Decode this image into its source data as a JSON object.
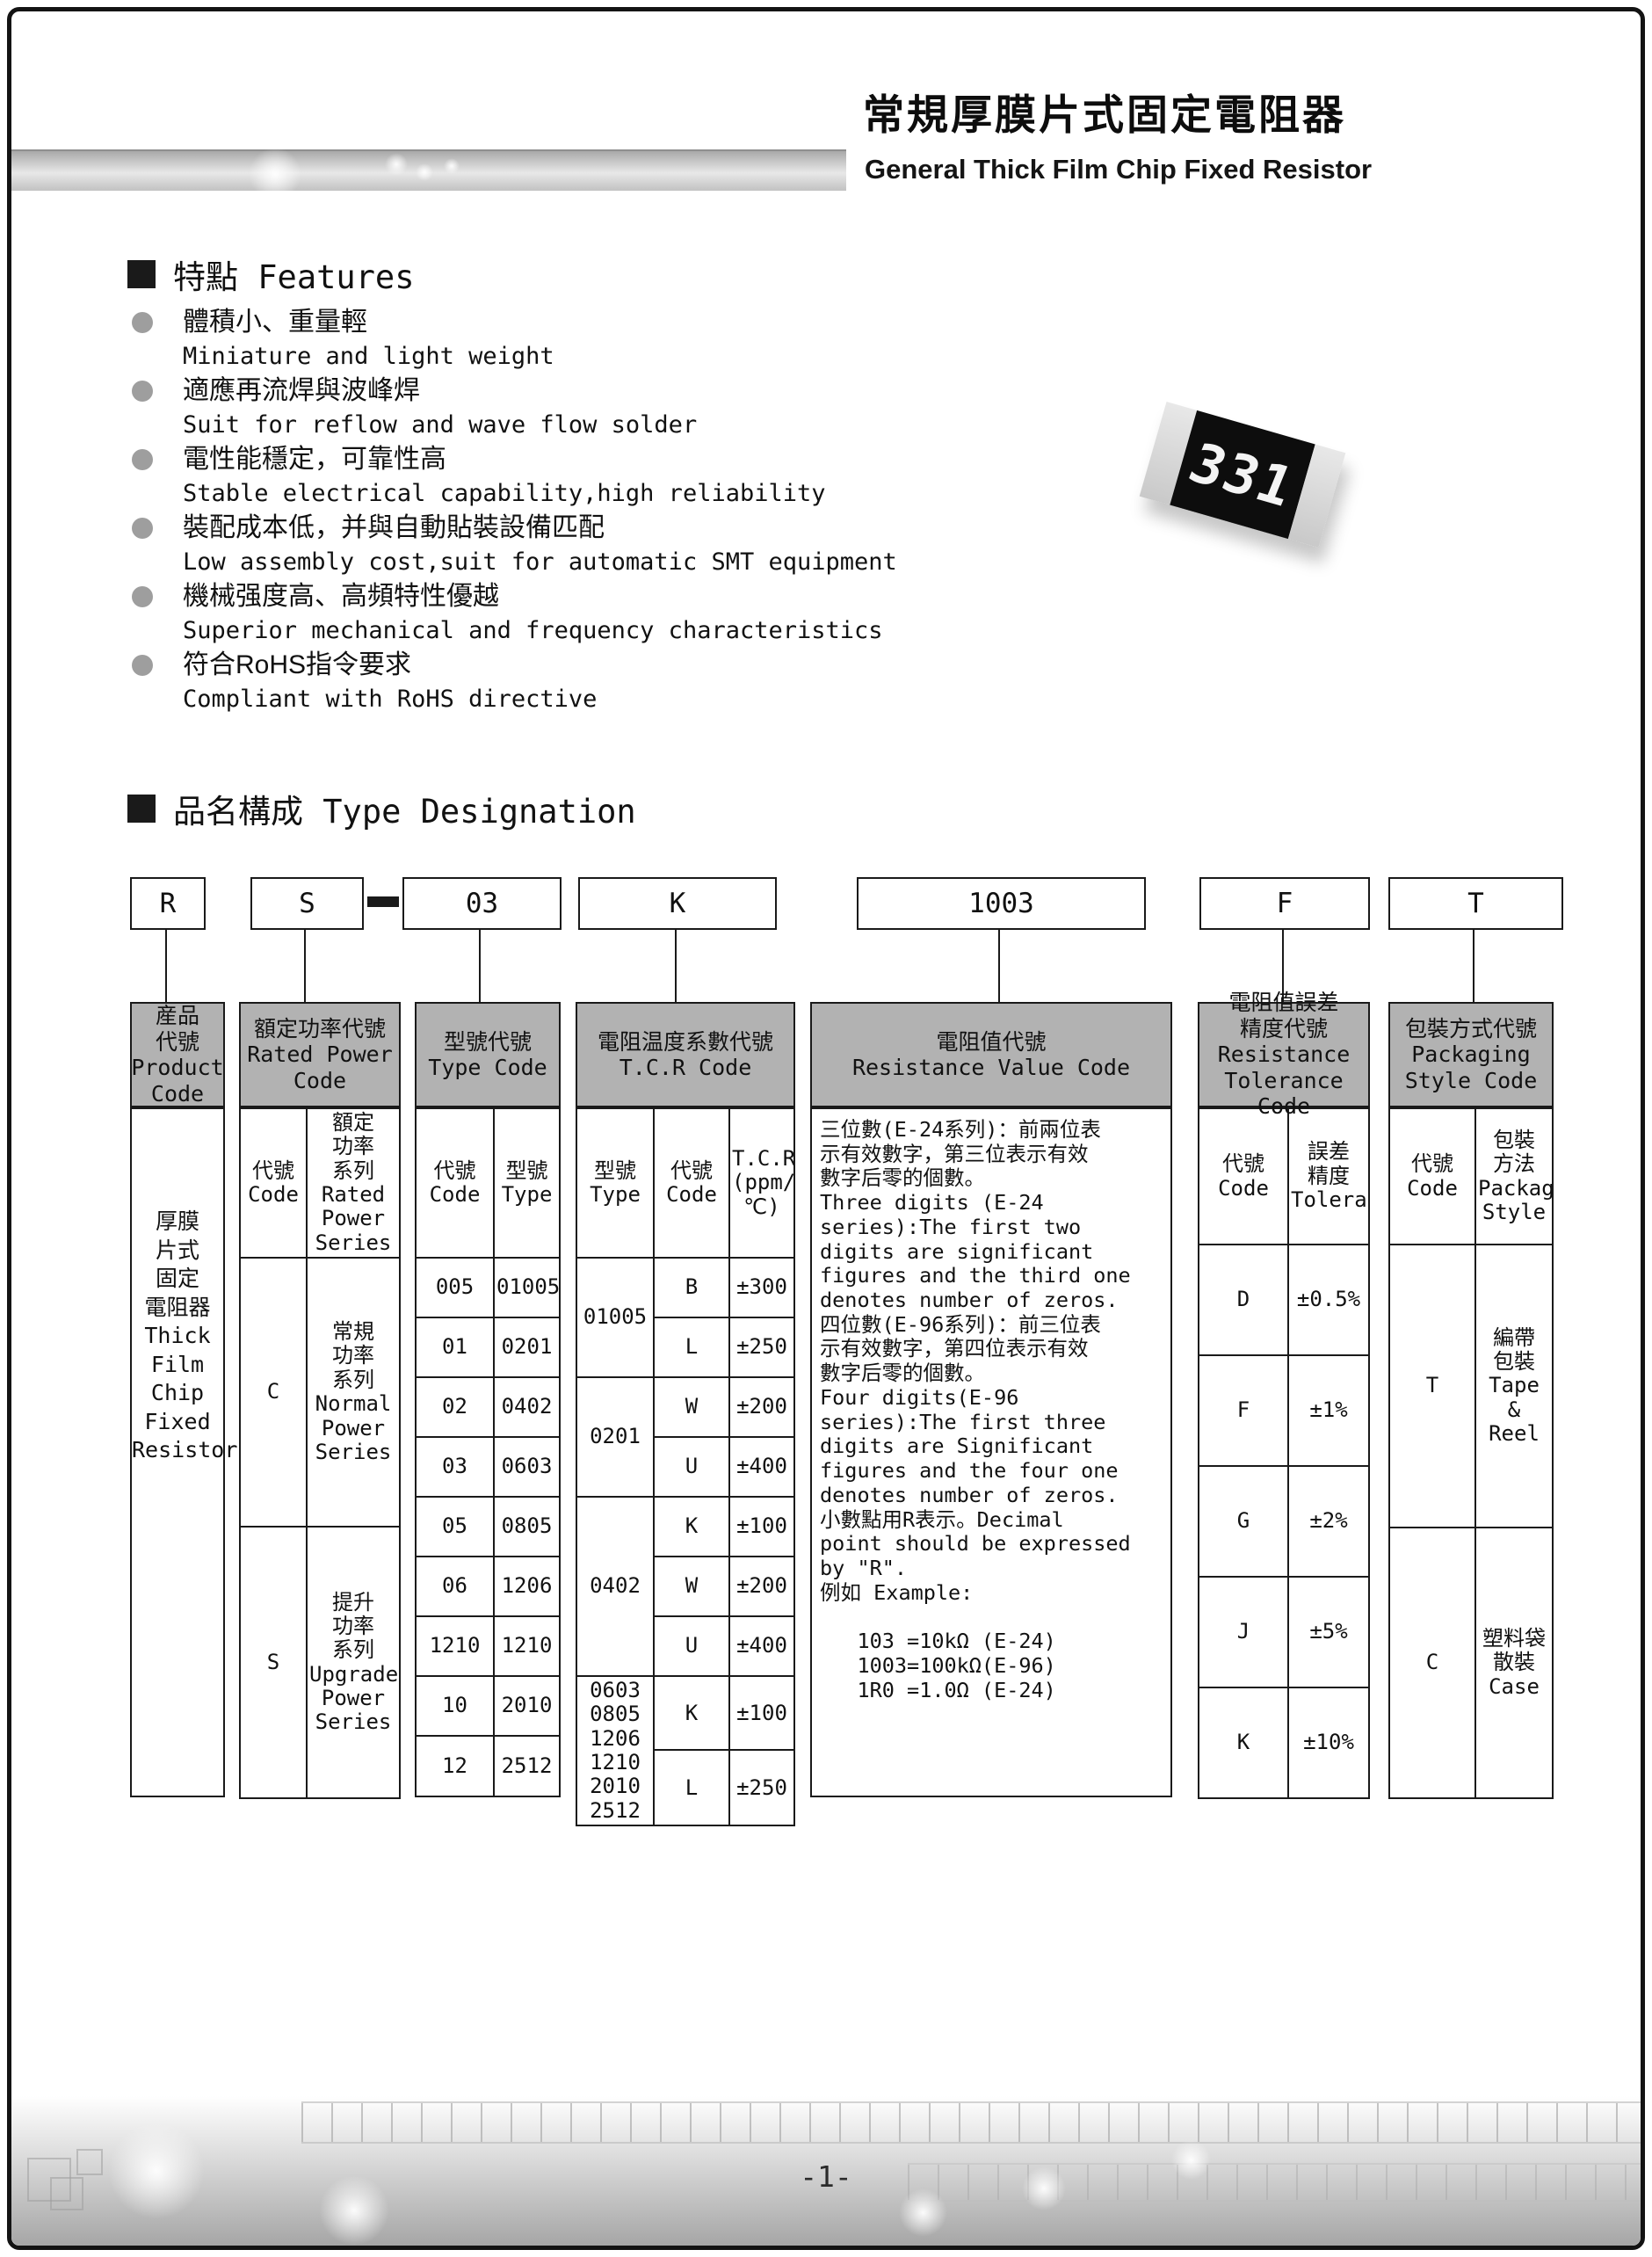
{
  "header": {
    "title_zh": "常規厚膜片式固定電阻器",
    "title_en": "General Thick Film Chip Fixed Resistor"
  },
  "features": {
    "heading": "特點 Features",
    "items": [
      {
        "zh": "體積小、重量輕",
        "en": "Miniature and light weight"
      },
      {
        "zh": "適應再流焊與波峰焊",
        "en": "Suit for reflow and wave flow solder"
      },
      {
        "zh": "電性能穩定，可靠性高",
        "en": "Stable electrical capability,high reliability"
      },
      {
        "zh": "裝配成本低，并與自動貼裝設備匹配",
        "en": "Low assembly cost,suit for automatic SMT equipment"
      },
      {
        "zh": "機械强度高、高頻特性優越",
        "en": "Superior mechanical and frequency characteristics"
      },
      {
        "zh": "符合RoHS指令要求",
        "en": "Compliant with RoHS directive"
      }
    ]
  },
  "chip": {
    "marking": "331"
  },
  "type_designation": {
    "heading": "品名構成  Type Designation",
    "codes": [
      "R",
      "S",
      "03",
      "K",
      "1003",
      "F",
      "T"
    ],
    "product": {
      "header": "産品\n代號\nProduct\nCode",
      "body": "厚膜\n片式\n固定\n電阻器\nThick\nFilm\nChip\nFixed\nResistor"
    },
    "rated_power": {
      "header": "額定功率代號\nRated Power\nCode",
      "sub_code": "代號\nCode",
      "sub_series": "額定\n功率\n系列\nRated\nPower\nSeries",
      "rows": [
        {
          "code": "C",
          "series": "常規\n功率\n系列\nNormal\nPower\nSeries"
        },
        {
          "code": "S",
          "series": "提升\n功率\n系列\nUpgraded\nPower\nSeries"
        }
      ]
    },
    "type_code": {
      "header": "型號代號\nType Code",
      "sub_code": "代號\nCode",
      "sub_type": "型號\nType",
      "rows": [
        {
          "code": "005",
          "type": "01005"
        },
        {
          "code": "01",
          "type": "0201"
        },
        {
          "code": "02",
          "type": "0402"
        },
        {
          "code": "03",
          "type": "0603"
        },
        {
          "code": "05",
          "type": "0805"
        },
        {
          "code": "06",
          "type": "1206"
        },
        {
          "code": "1210",
          "type": "1210"
        },
        {
          "code": "10",
          "type": "2010"
        },
        {
          "code": "12",
          "type": "2512"
        }
      ]
    },
    "tcr": {
      "header": "電阻温度系數代號\nT.C.R Code",
      "sub_type": "型號\nType",
      "sub_code": "代號\nCode",
      "sub_tcr": "T.C.R\n(ppm/℃)",
      "groups": [
        {
          "type": "01005",
          "rows": [
            {
              "code": "B",
              "tcr": "±300"
            },
            {
              "code": "L",
              "tcr": "±250"
            }
          ]
        },
        {
          "type": "0201",
          "rows": [
            {
              "code": "W",
              "tcr": "±200"
            },
            {
              "code": "U",
              "tcr": "±400"
            }
          ]
        },
        {
          "type": "0402",
          "rows": [
            {
              "code": "K",
              "tcr": "±100"
            },
            {
              "code": "W",
              "tcr": "±200"
            },
            {
              "code": "U",
              "tcr": "±400"
            }
          ]
        },
        {
          "type": "0603\n0805\n1206\n1210\n2010\n2512",
          "rows": [
            {
              "code": "K",
              "tcr": "±100"
            },
            {
              "code": "L",
              "tcr": "±250"
            }
          ]
        }
      ]
    },
    "resistance_value": {
      "header": "電阻值代號\nResistance Value Code",
      "body": "三位數(E-24系列)：前兩位表\n示有效數字，第三位表示有效\n數字后零的個數。\nThree digits (E-24\nseries):The first two\ndigits are significant\nfigures and the third one\ndenotes number of zeros.\n四位數(E-96系列)：前三位表\n示有效數字，第四位表示有效\n數字后零的個數。\nFour digits(E-96\nseries):The first three\ndigits are Significant\nfigures and the four one\ndenotes number of zeros.\n小數點用R表示。Decimal\npoint should be expressed\nby \"R\".\n例如 Example:\n\n   103 =10kΩ (E-24)\n   1003=100kΩ(E-96)\n   1R0 =1.0Ω (E-24)"
    },
    "tolerance": {
      "header": "電阻值誤差\n精度代號\nResistance\nTolerance Code",
      "sub_code": "代號\nCode",
      "sub_tol": "誤差\n精度\nTolerance",
      "rows": [
        {
          "code": "D",
          "tol": "±0.5%"
        },
        {
          "code": "F",
          "tol": "±1%"
        },
        {
          "code": "G",
          "tol": "±2%"
        },
        {
          "code": "J",
          "tol": "±5%"
        },
        {
          "code": "K",
          "tol": "±10%"
        }
      ]
    },
    "packaging": {
      "header": "包裝方式代號\nPackaging\nStyle Code",
      "sub_code": "代號\nCode",
      "sub_style": "包裝\n方法\nPackaging\nStyle",
      "rows": [
        {
          "code": "T",
          "style": "編帶\n包裝\nTape\n&\nReel"
        },
        {
          "code": "C",
          "style": "塑料袋\n散裝\nCase"
        }
      ]
    }
  },
  "footer": {
    "page_number": "-1-"
  },
  "colors": {
    "table_header_gray": "#b2b2b2",
    "border_black": "#1a1a1a",
    "bullet_gray": "#9e9e9e",
    "band_gray": "#c2c2c2"
  }
}
